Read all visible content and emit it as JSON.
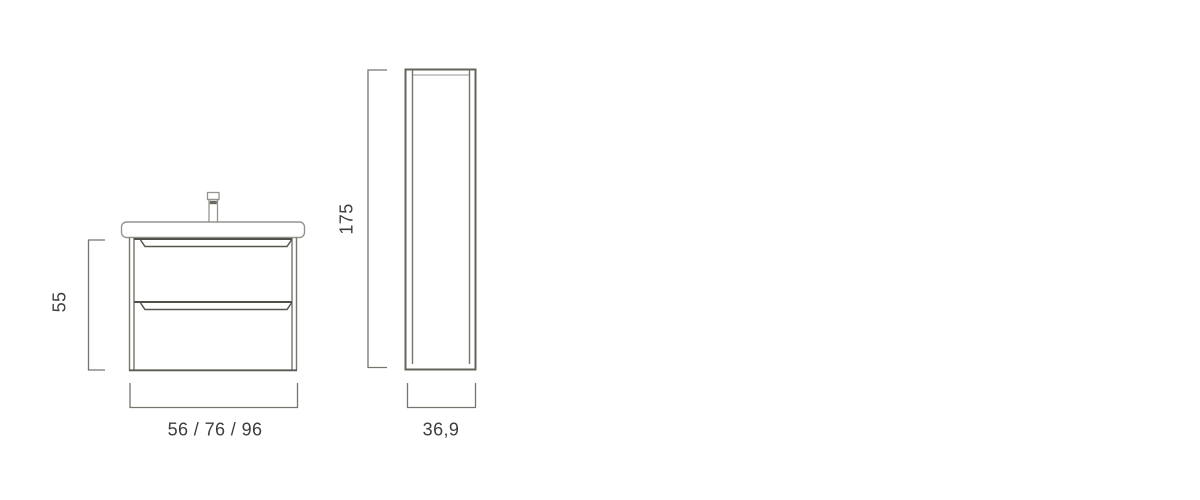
{
  "drawing": {
    "title_semantic": "bathroom-furniture-dimension-diagram",
    "vanity_unit": {
      "view": "front",
      "height_label": "55",
      "width_label": "56 / 76 / 96",
      "features": [
        "faucet",
        "washbasin",
        "two-drawers"
      ]
    },
    "tall_column_cabinet": {
      "view": "side",
      "height_label": "175",
      "width_label": "36,9"
    }
  },
  "colors": {
    "background": "#ffffff",
    "line_medium": "#75756e",
    "line_dark": "#51514b",
    "line_light": "#94948e",
    "text": "#3d3d3b"
  }
}
